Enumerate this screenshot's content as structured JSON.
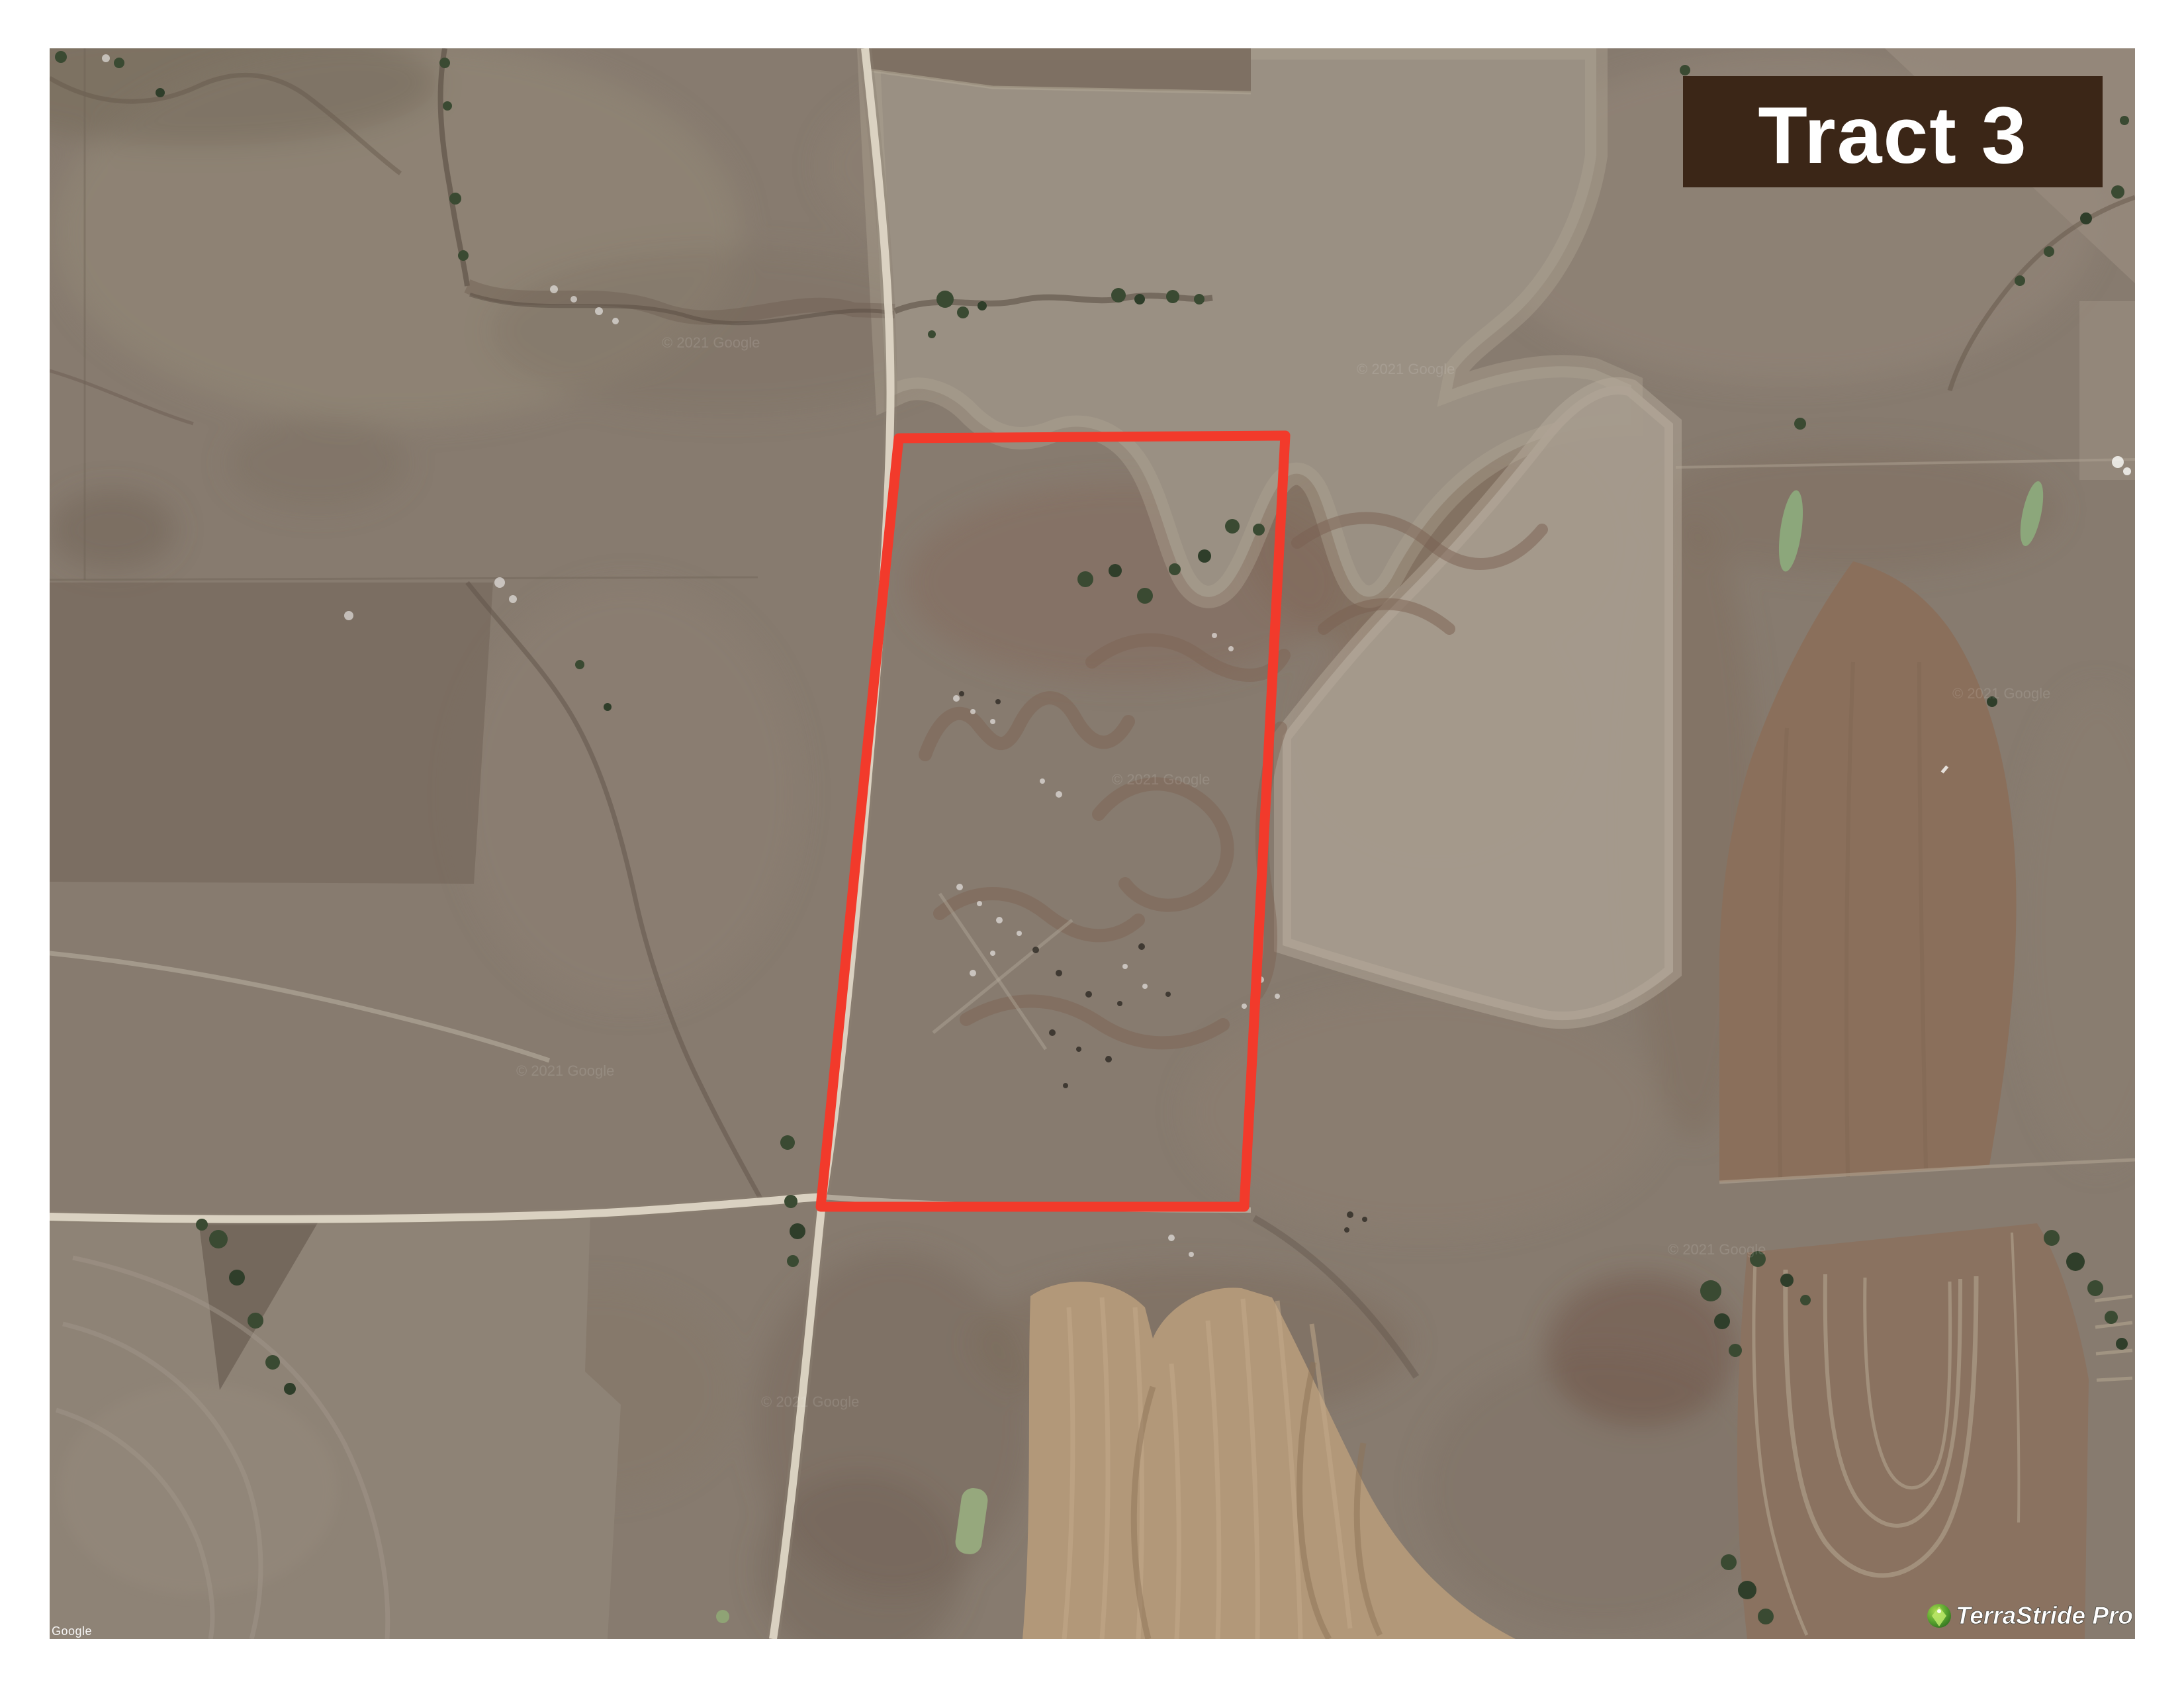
{
  "map": {
    "description": "aerial satellite view of farmland sections with dirt roads, plowed fields, pasture, ponds and tree lines",
    "google_watermark": "Google",
    "copyright_watermark": "© 2021 Google",
    "branding_watermark": "TerraStride Pro"
  },
  "tract_label": {
    "text": "Tract 3",
    "bg_color": "#3b2617",
    "text_color": "#ffffff"
  },
  "tract_boundary": {
    "color": "#f23a2b",
    "stroke_width": 15
  },
  "palette": {
    "map_base": "#877b6f",
    "plowed_light": "#9a9083",
    "plowed_grey": "#a59b8d",
    "field_brown": "#8a6f5b",
    "field_tan_warm": "#b29879",
    "road": "#ded6c5",
    "trees": "#3a4a32",
    "pond": "#8ca77b",
    "logo_green": "#5aa530"
  }
}
